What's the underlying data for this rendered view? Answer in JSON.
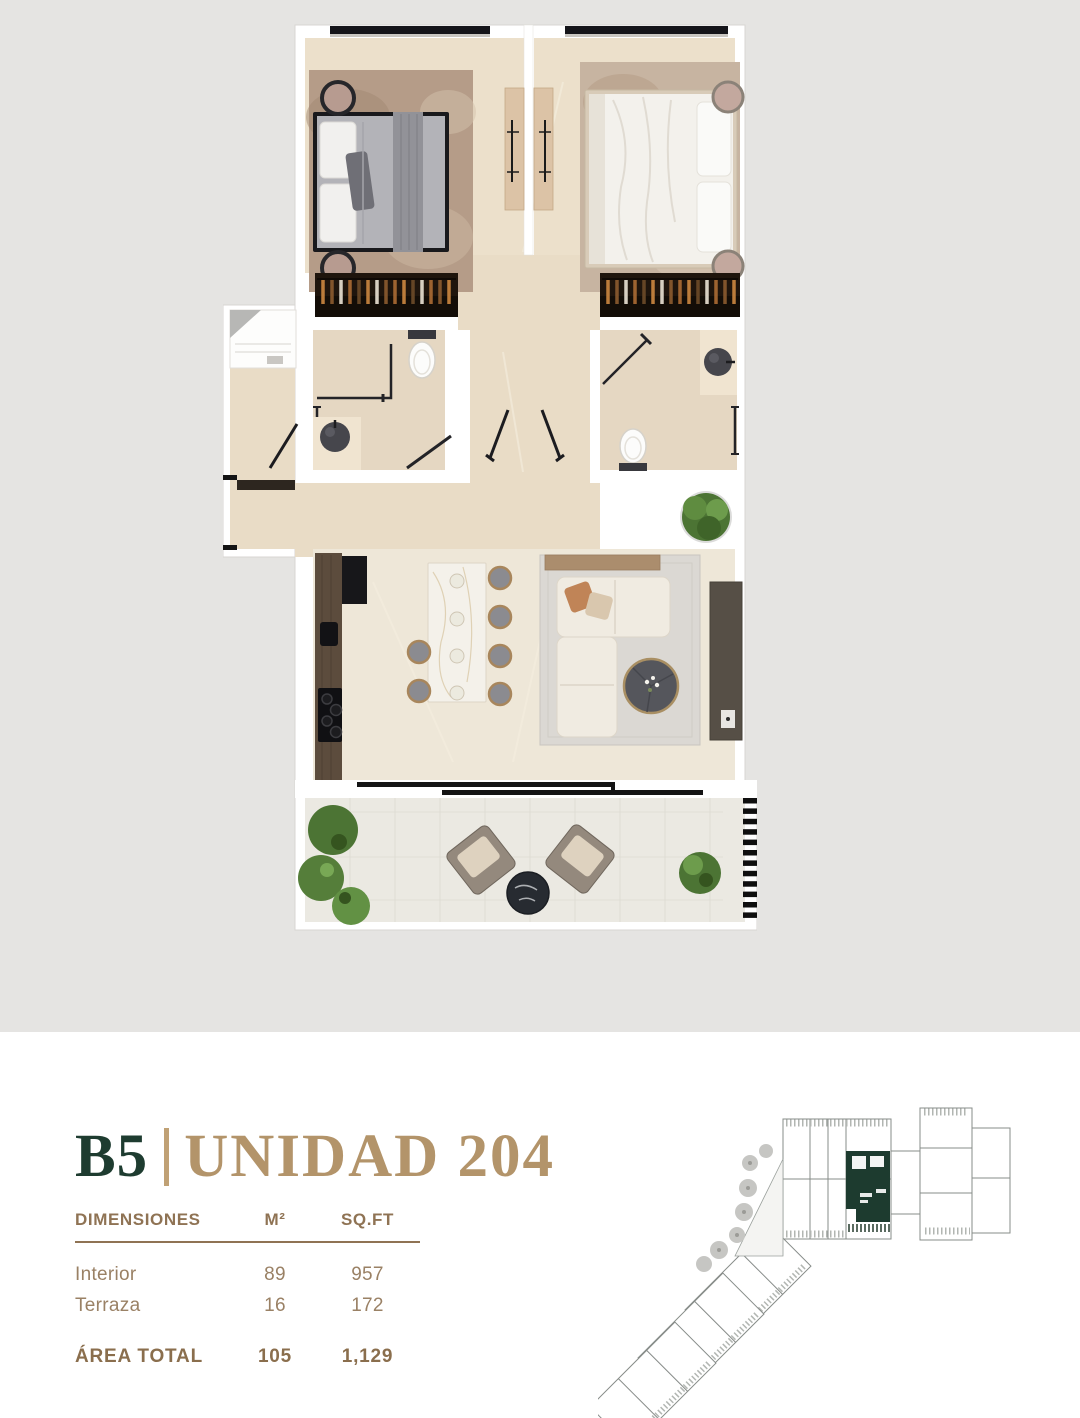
{
  "unit_header": {
    "block": "B5",
    "separator": "|",
    "unit_name": "UNIDAD 204"
  },
  "dimensions_table": {
    "header": {
      "label": "DIMENSIONES",
      "col_m2": "M²",
      "col_sqft": "SQ.FT"
    },
    "rows": [
      {
        "label": "Interior",
        "m2": "89",
        "sqft": "957"
      },
      {
        "label": "Terraza",
        "m2": "16",
        "sqft": "172"
      }
    ],
    "total": {
      "label": "ÁREA TOTAL",
      "m2": "105",
      "sqft": "1,129"
    }
  },
  "colors": {
    "hero_background": "#e5e4e2",
    "block_green": "#1e3c30",
    "accent_gold": "#b3946a",
    "table_header_gold": "#8f7354",
    "table_text": "#9a8165",
    "keyplan_highlight_green": "#1d3b2f",
    "plan_floor_beige": "#e9dcc6",
    "plan_wall_white": "#ffffff"
  }
}
